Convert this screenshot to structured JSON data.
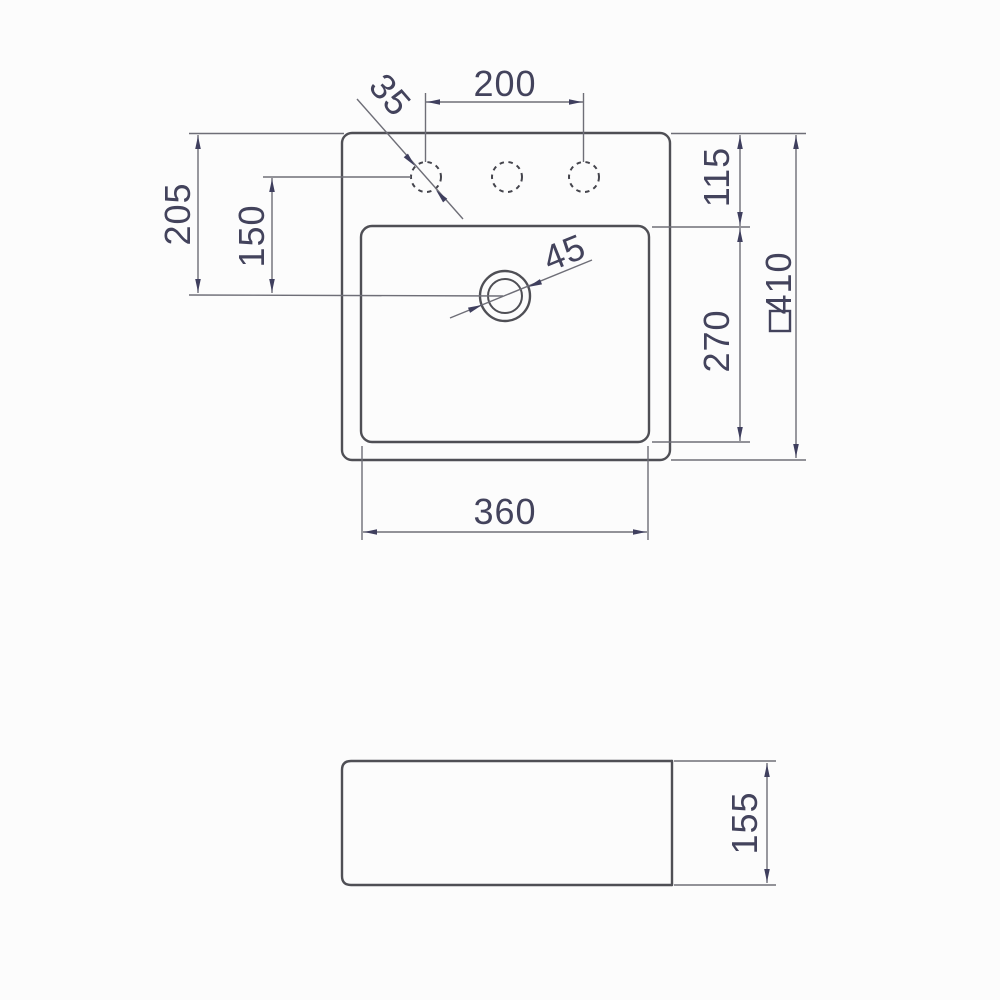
{
  "drawing": {
    "title": "square-countertop-basin-technical-drawing",
    "colors": {
      "background": "#fcfcfc",
      "object_line": "#4f4f55",
      "dimension_line": "#6e6e77",
      "annotation": "#3f3f5e"
    },
    "top_view": {
      "dimensions": {
        "faucet_hole_spacing": "200",
        "faucet_hole_diameter": "35",
        "rim_top_to_drain_center": "205",
        "hole_center_to_drain_center": "150",
        "rim_top_to_basin_edge": "115",
        "basin_front_to_back": "270",
        "overall_square_size": "410",
        "basin_width": "360",
        "drain_diameter": "45"
      }
    },
    "side_view": {
      "dimensions": {
        "overall_height": "155"
      }
    }
  }
}
